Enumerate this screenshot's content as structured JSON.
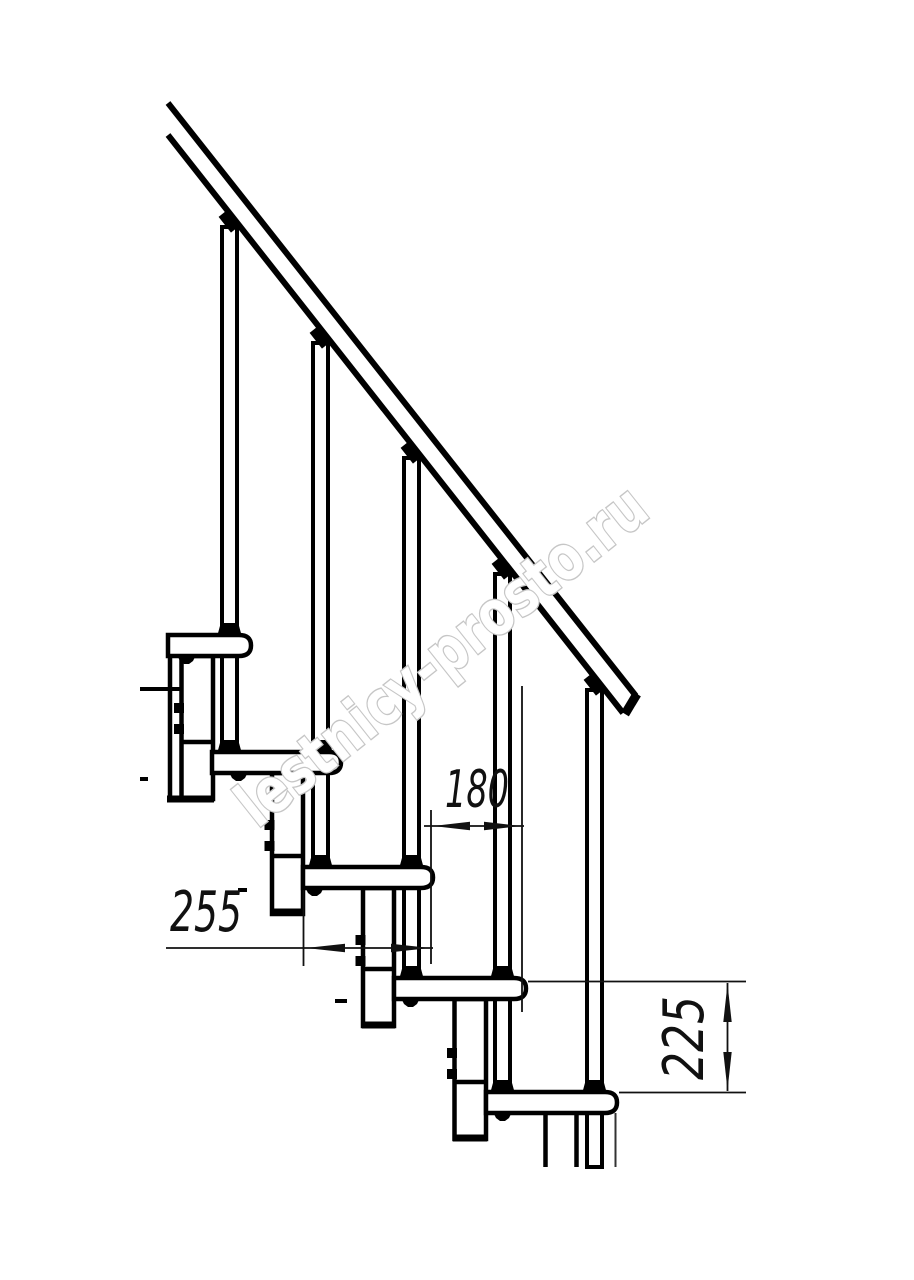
{
  "colors": {
    "background": "#ffffff",
    "line": "#000000",
    "dimension": "#111111",
    "watermark_outline": "#c6c6c6"
  },
  "dimensions": {
    "step_run": "255",
    "nose_spacing": "180",
    "step_rise": "225"
  },
  "watermark": {
    "text": "lestnicy-prosto.ru"
  }
}
